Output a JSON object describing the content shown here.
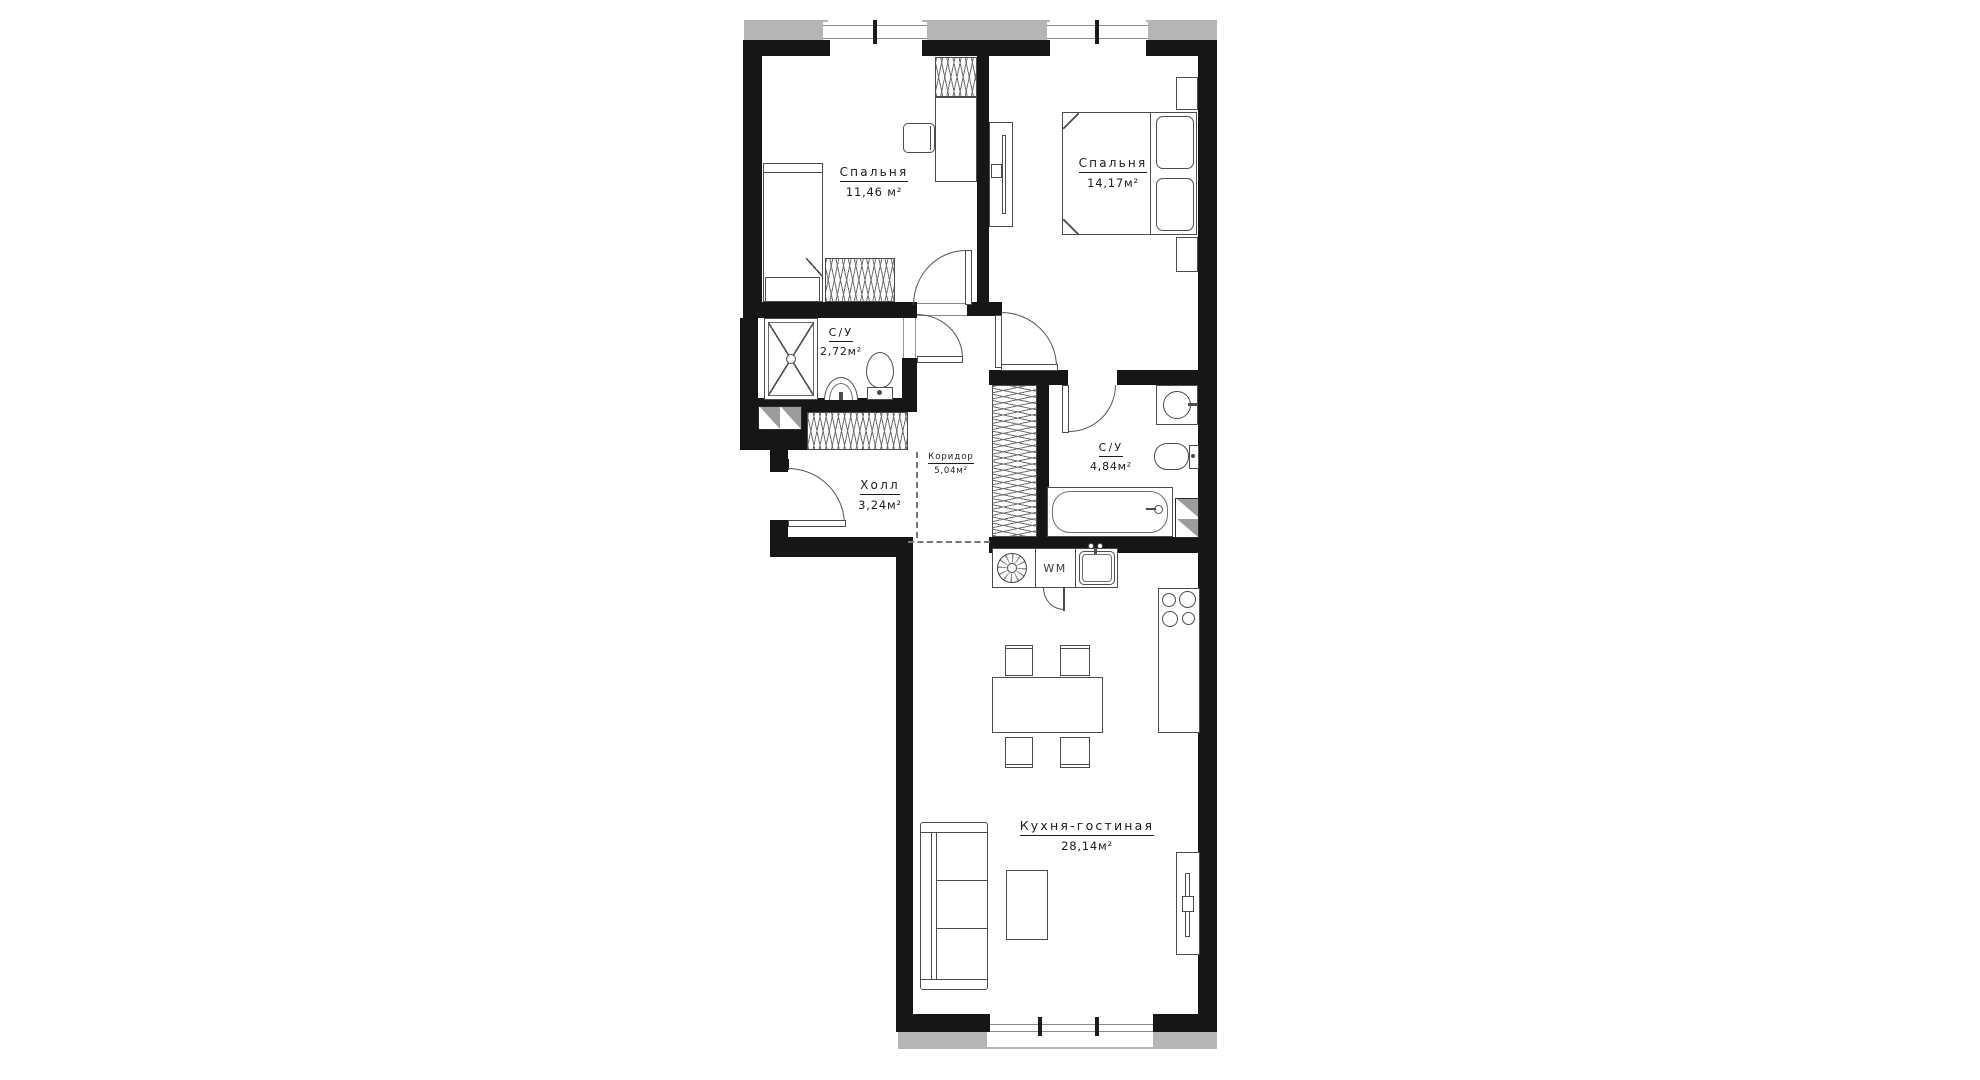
{
  "plan": {
    "rooms": [
      {
        "id": "bedroom-1",
        "name": "Спальня",
        "area": "11,46 м²"
      },
      {
        "id": "bedroom-2",
        "name": "Спальня",
        "area": "14,17м²"
      },
      {
        "id": "bathroom-1",
        "name": "С/У",
        "area": "2,72м²"
      },
      {
        "id": "bathroom-2",
        "name": "С/У",
        "area": "4,84м²"
      },
      {
        "id": "hall",
        "name": "Холл",
        "area": "3,24м²"
      },
      {
        "id": "corridor",
        "name": "Коридор",
        "area": "5,04м²"
      },
      {
        "id": "kitchen-living",
        "name": "Кухня-гостиная",
        "area": "28,14м²"
      }
    ],
    "appliance_labels": {
      "washing_machine": "WM"
    },
    "colors": {
      "wall": "#161616",
      "pier": "#b5b5b5",
      "vent": "#9c9c9c",
      "furniture_line": "#4c4c4c",
      "text": "#1b1b1b"
    },
    "icons": [
      "window-icon",
      "door-swing-icon",
      "bed-icon",
      "wardrobe-hatch-icon",
      "desk-icon",
      "chair-icon",
      "tv-icon",
      "shower-icon",
      "toilet-icon",
      "basin-icon",
      "bathtub-icon",
      "vent-shaft-icon",
      "washer-drum-icon",
      "kitchen-sink-icon",
      "hob-burners-icon",
      "dining-table-icon",
      "sofa-icon",
      "coffee-table-icon"
    ]
  }
}
